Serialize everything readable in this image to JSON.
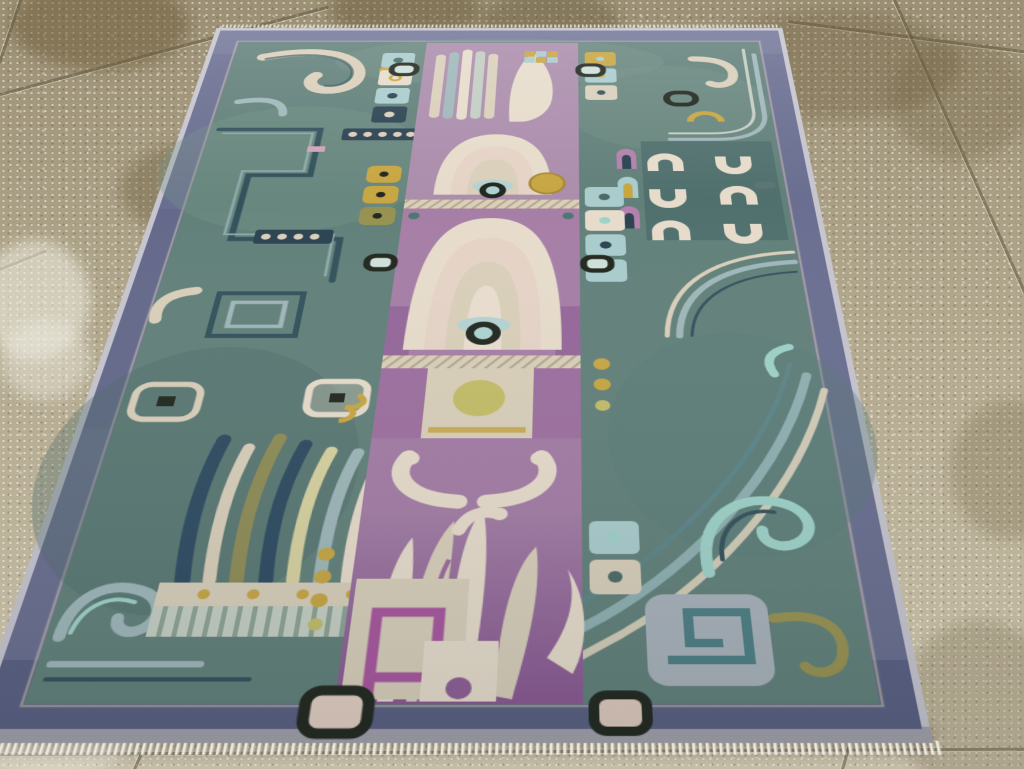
{
  "scene": {
    "type": "photograph",
    "description": "Antique East Turkestan Khotan pictorial wool rug with two large cream fan medallions and eye motifs on a lilac-purple central column, flanked by teal-green quadrants of angular cloud-scroll meanders, feather bundles, horseshoe cups and gold accents, inside a slate blue-violet border with white fringe, lying on a beige speckled concrete tile floor photographed at an oblique angle",
    "subject": "ornate pictorial area rug",
    "setting": "speckled concrete tile floor with grout lines and damp stains",
    "motifs": [
      "fan-medallion",
      "eye-ring",
      "flame-blades",
      "ram-horn-scrolls",
      "cloud-meander",
      "feather-bundle",
      "horseshoe-cups",
      "sun-disk",
      "greek-spiral",
      "checker-squares",
      "fringe"
    ],
    "colors": {
      "floor-base": "#b2a88e",
      "grout": "#857d63",
      "rug-edge": "#c6c5cf",
      "rug-border": "#6a6e90",
      "rug-border-dark": "#565b7e",
      "bottom-strip": "#a3a1ad",
      "field": "#62807a",
      "field-light": "#779489",
      "field-dark": "#4d6a66",
      "teal-deep": "#33525c",
      "navy": "#2c4352",
      "blue-steel": "#9fb7ba",
      "blue-light": "#aacccd",
      "teal-bright": "#9ed2c8",
      "cream": "#d9cfba",
      "cream-warm": "#e7dccb",
      "pink-cream": "#e5d3c6",
      "purple": "#a282a4",
      "purple-light": "#ab8dac",
      "purple-med": "#a67ea6",
      "purple-deep": "#8f5e96",
      "mauve": "#b381ac",
      "spiral-purple": "#a8569e",
      "pink": "#d0a3b8",
      "gold": "#c7a643",
      "olive": "#989251",
      "olive-circle": "#c3bd68",
      "ink": "#22281f",
      "eye-center": "#aed2d2",
      "fringe": "#eae7de"
    }
  }
}
